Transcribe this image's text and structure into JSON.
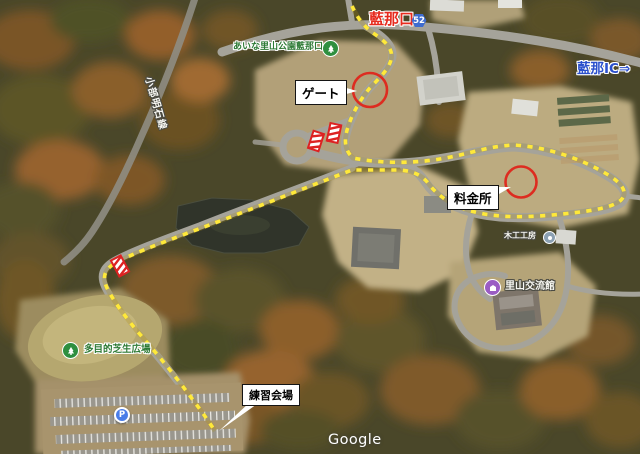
{
  "map_labels": {
    "entrance_name": "藍那口",
    "route_badge": "52",
    "park_entrance": "あいな里山公園藍那口",
    "road_name": "小部明石線",
    "interchange": "藍那IC⇒",
    "workshop": "木工工房",
    "exchange_hall": "里山交流館",
    "lawn_plaza": "多目的芝生広場",
    "parking_symbol": "P"
  },
  "map_overlay": {
    "route_color": "#ffe93a",
    "highlight_color": "#dd2c20",
    "callouts": {
      "gate": "ゲート",
      "toll_booth": "料金所",
      "practice_venue": "練習会場"
    }
  },
  "watermark": "Google"
}
